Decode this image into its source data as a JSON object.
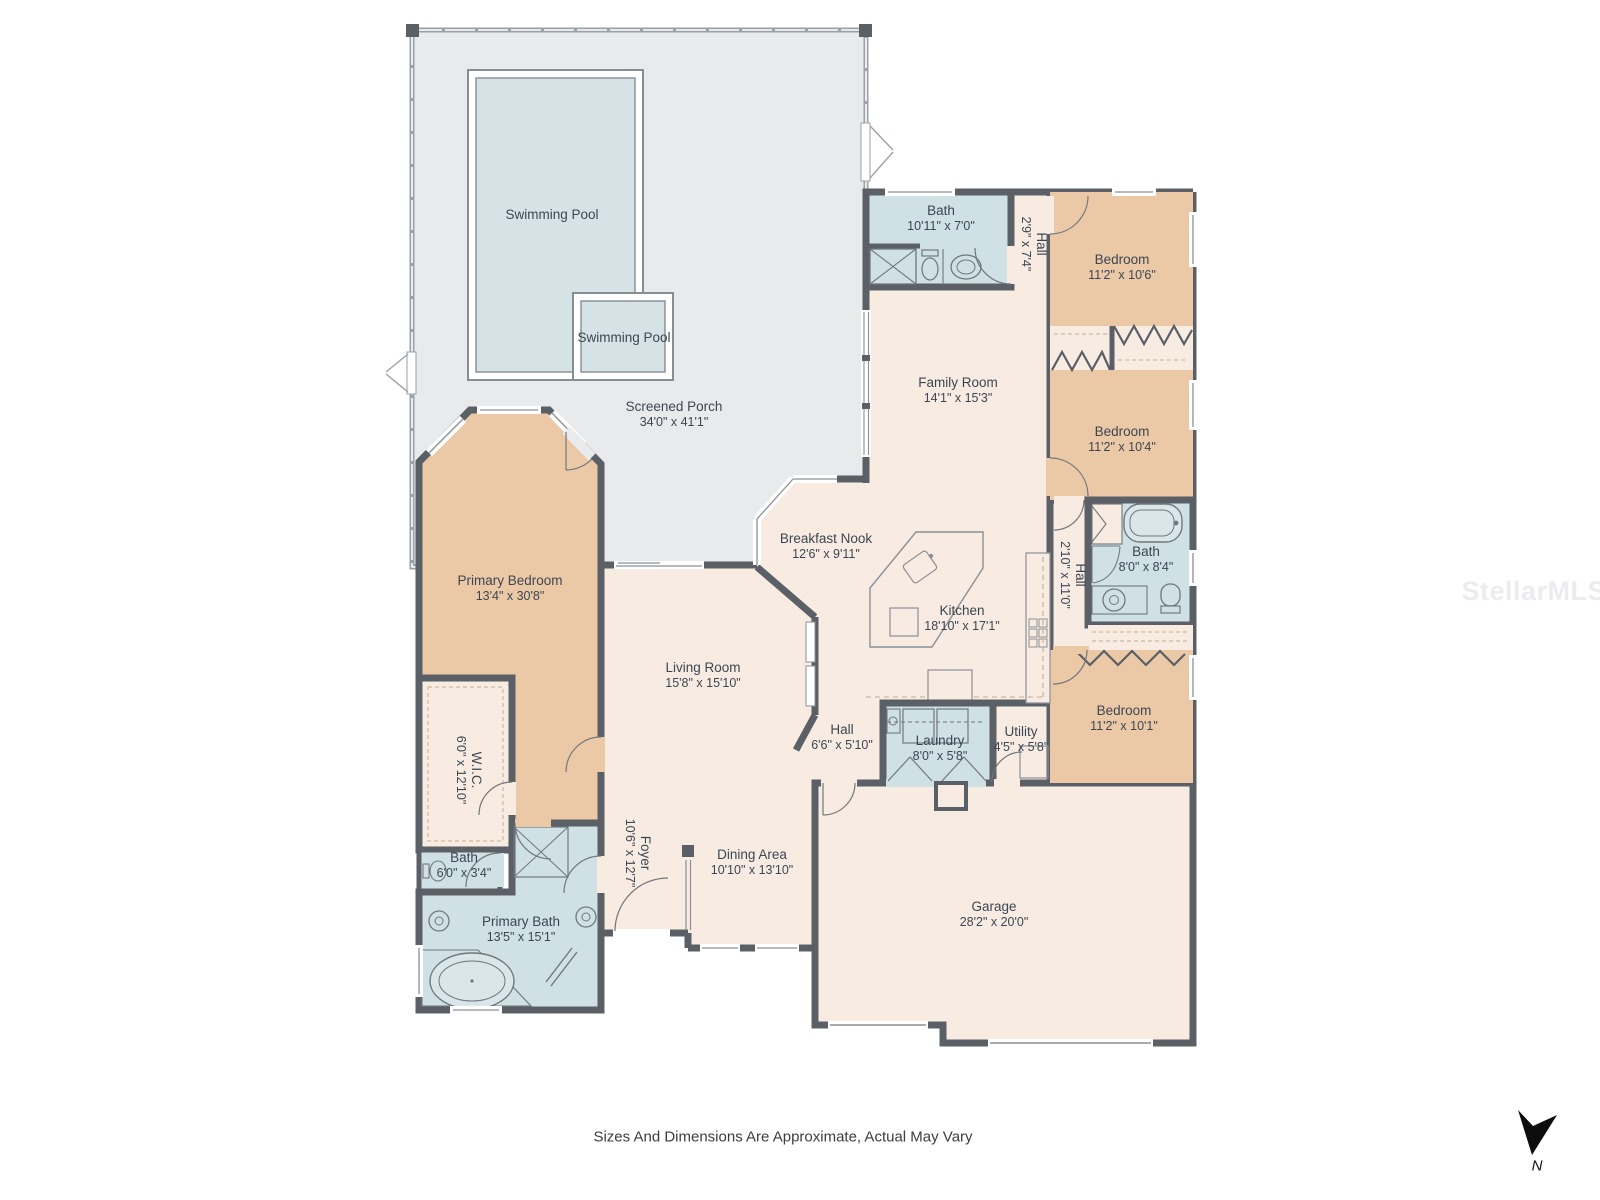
{
  "colors": {
    "wall": "#5b5f66",
    "room_cream": "#f8ece2",
    "room_tan": "#ebc9a6",
    "room_wet_blue": "#cfe1e5",
    "porch_gray": "#e9eaec",
    "pool_water": "#d6e3e6",
    "label_text": "#3c4653"
  },
  "pool": {
    "main_label": "Swimming Pool",
    "spa_label": "Swimming Pool"
  },
  "rooms": {
    "screened_porch": {
      "name": "Screened Porch",
      "dims": "34'0\" x 41'1\""
    },
    "bath_top": {
      "name": "Bath",
      "dims": "10'11\" x 7'0\""
    },
    "hall_top": {
      "name": "Hall",
      "dims": "2'9\" x 7'4\""
    },
    "bedroom1": {
      "name": "Bedroom",
      "dims": "11'2\" x 10'6\""
    },
    "family_room": {
      "name": "Family Room",
      "dims": "14'1\" x 15'3\""
    },
    "bedroom2": {
      "name": "Bedroom",
      "dims": "11'2\" x 10'4\""
    },
    "breakfast_nook": {
      "name": "Breakfast Nook",
      "dims": "12'6\" x 9'11\""
    },
    "bath_right": {
      "name": "Bath",
      "dims": "8'0\" x 8'4\""
    },
    "hall_right": {
      "name": "Hall",
      "dims": "2'10\" x 11'0\""
    },
    "kitchen": {
      "name": "Kitchen",
      "dims": "18'10\" x 17'1\""
    },
    "primary_bedroom": {
      "name": "Primary Bedroom",
      "dims": "13'4\" x 30'8\""
    },
    "living_room": {
      "name": "Living Room",
      "dims": "15'8\" x 15'10\""
    },
    "hall_center": {
      "name": "Hall",
      "dims": "6'6\" x 5'10\""
    },
    "laundry": {
      "name": "Laundry",
      "dims": "8'0\" x 5'8\""
    },
    "utility": {
      "name": "Utility",
      "dims": "4'5\" x 5'8\""
    },
    "bedroom3": {
      "name": "Bedroom",
      "dims": "11'2\" x 10'1\""
    },
    "wic": {
      "name": "W.I.C.",
      "dims": "6'0\" x 12'10\""
    },
    "bath_small": {
      "name": "Bath",
      "dims": "6'0\" x 3'4\""
    },
    "foyer": {
      "name": "Foyer",
      "dims": "10'6\" x 12'7\""
    },
    "dining_area": {
      "name": "Dining Area",
      "dims": "10'10\" x 13'10\""
    },
    "primary_bath": {
      "name": "Primary Bath",
      "dims": "13'5\" x 15'1\""
    },
    "garage": {
      "name": "Garage",
      "dims": "28'2\" x 20'0\""
    }
  },
  "footer": {
    "disclaimer": "Sizes And Dimensions Are Approximate, Actual May Vary"
  },
  "compass": {
    "north_label": "N"
  },
  "watermark": {
    "text": "StellarMLS"
  }
}
